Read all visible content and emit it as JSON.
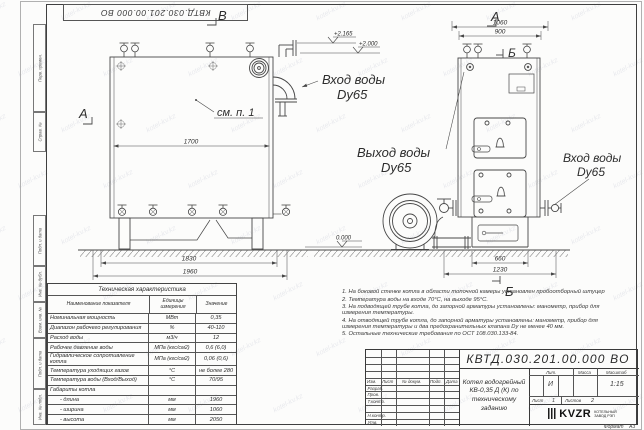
{
  "meta": {
    "drawing_code": "КВТД.030.201.00.000  ВО",
    "format_label": "Формат",
    "format_value": "А3"
  },
  "frame": {
    "left_labels": [
      "Перв. примен.",
      "Справ. №",
      "Подп. и дата",
      "Инв. № дубл.",
      "Взам. инв. №",
      "Подп. и дата",
      "Инв. № подл."
    ]
  },
  "views": {
    "left": {
      "label_top": "В",
      "label_left": "А",
      "note": "см. п. 1",
      "dim_inner": "1700",
      "dim_base": "1830",
      "dim_overall": "1960"
    },
    "right": {
      "label_top": "А",
      "label_side": "Б",
      "label_bottom": "Б",
      "dim_overall": "1060",
      "dim_body": "900",
      "dim_base": "660",
      "dim_full": "1230"
    },
    "elev": {
      "high": "+2.165",
      "mid": "+2.000",
      "zero": "0.000"
    },
    "ports": {
      "inlet_top": [
        "Вход воды",
        "Dу65"
      ],
      "outlet": [
        "Выход воды",
        "Dу65"
      ],
      "inlet_right": [
        "Вход воды",
        "Dу65"
      ]
    }
  },
  "spec_table": {
    "title": "Техническая характеристика",
    "col_name": "Наименование показателя",
    "col_units": "Единицы измерения",
    "col_value": "Значение",
    "rows": [
      [
        "Номинальная мощность",
        "МВт",
        "0,35"
      ],
      [
        "Диапазон рабочего регулирования",
        "%",
        "40-110"
      ],
      [
        "Расход воды",
        "м3/ч",
        "12"
      ],
      [
        "Рабочее давление воды",
        "МПа (кгс/см2)",
        "0,6 (6,0)"
      ],
      [
        "Гидравлическое сопротивление котла",
        "МПа (кгс/см2)",
        "0,06 (0,6)"
      ],
      [
        "Температура уходящих газов",
        "°С",
        "не более 280"
      ],
      [
        "Температура воды (Вход/Выход)",
        "°С",
        "70/95"
      ],
      [
        "Габариты котла",
        "",
        ""
      ],
      [
        "- длина",
        "мм",
        "1960"
      ],
      [
        "- ширина",
        "мм",
        "1060"
      ],
      [
        "- высота",
        "мм",
        "2050"
      ]
    ]
  },
  "notes": [
    "1.  На боковой стенке котла в области топочной камеры установлен пробоотборный штуцер",
    "2.  Температура воды на входе 70°С, на выходе 95°С.",
    "3.  На подводящей трубе котла, до запорной арматуры установлены: манометр, прибор для измерения температуры.",
    "4.  На отводящей трубе котла, до запорной арматуры установлены: манометр, прибор для измерения температуры и два предохранительных клапана Dу не менее 40 мм.",
    "5.  Остальные технические требования по ОСТ 108.030.133-84."
  ],
  "title_block": {
    "doc_number": "КВТД.030.201.00.000  ВО",
    "doc_name_lines": [
      "Котел водогрейный",
      "КВ-0,35 Д (К) по",
      "техническому заданию"
    ],
    "header_cols": [
      "Изм.",
      "Лист",
      "№ докум.",
      "Подп.",
      "Дата"
    ],
    "roles": [
      "Разраб.",
      "Пров.",
      "Т.контр.",
      "",
      "Н.контр.",
      "Утв."
    ],
    "lit_label": "Лит.",
    "lit_value": "И",
    "mass_label": "Масса",
    "scale_label": "Масштаб",
    "scale_value": "1:15",
    "sheet_label": "Лист",
    "sheet_value": "1",
    "sheets_label": "Листов",
    "sheets_value": "2",
    "company_logo": "KVZR",
    "company_line1": "КОТЕЛЬНЫЙ",
    "company_line2": "ЗАВОД РЭП"
  },
  "watermark": {
    "text": "kotel-kv.kz"
  }
}
